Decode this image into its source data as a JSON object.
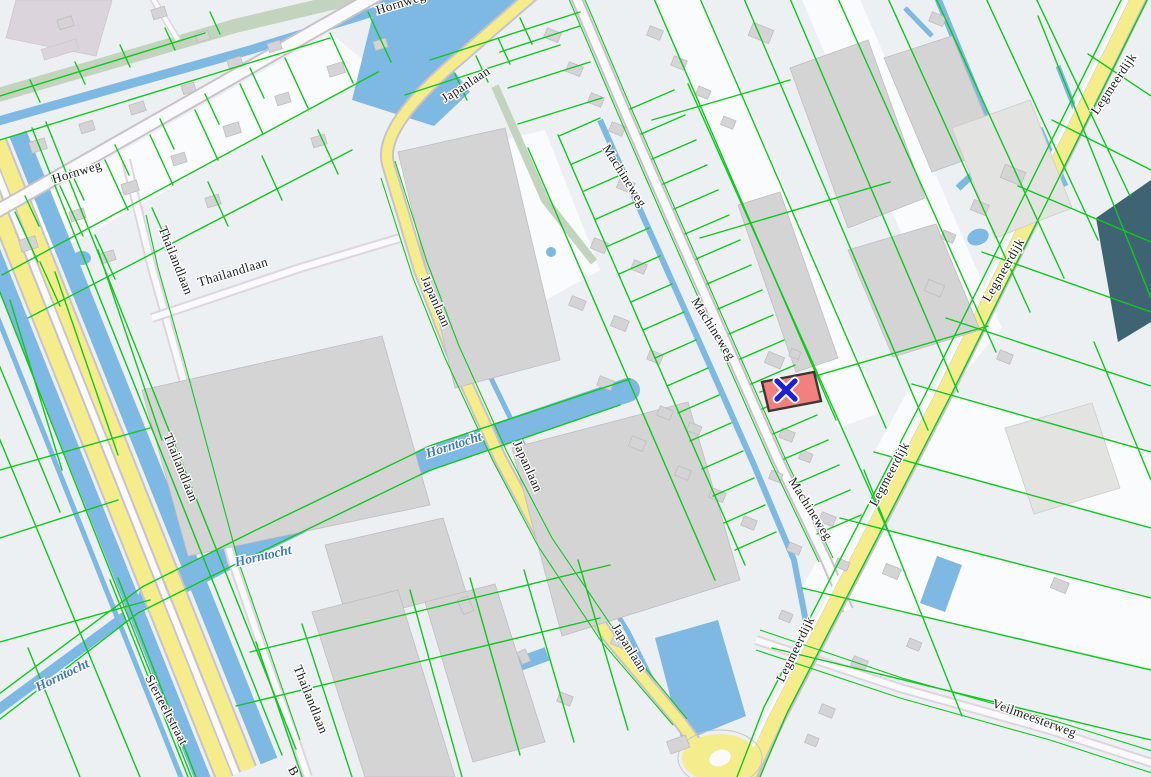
{
  "app": {
    "type": "cadastral-map-viewer",
    "description": "Dutch cadastral parcel map with highlighted parcel and selection marker"
  },
  "map": {
    "colors": {
      "bg": "#EDF0F3",
      "parcelLine": "#0FC81E",
      "water": "#7DB9E3",
      "roadYellow": "#F5EC8C",
      "roadWhite": "#FAF9FB",
      "roadCasing": "#C9C2C9",
      "minorCasing": "#DFD5DF",
      "building": "#D4D4D4",
      "buildingStroke": "#C2BCC2",
      "sage": "#C2D4BD",
      "darkParcel": "#3E6473",
      "lavender": "#DCD4DC",
      "parcelWhite": "#FAFBFC",
      "highlightFill": "#F2807E",
      "highlightStroke": "#3A3A30",
      "markerBlue": "#1B22D3",
      "labelText": "#1A1A1A",
      "waterText": "#3B79C4"
    },
    "labels": [
      {
        "text": "Hornweg",
        "x": 78,
        "y": 176,
        "rot": -17,
        "kind": "road"
      },
      {
        "text": "Hornweg",
        "x": 402,
        "y": 7,
        "rot": -17,
        "kind": "road"
      },
      {
        "text": "Japanlaan",
        "x": 468,
        "y": 88,
        "rot": -33,
        "kind": "road"
      },
      {
        "text": "Japanlaan",
        "x": 432,
        "y": 303,
        "rot": 66,
        "kind": "road"
      },
      {
        "text": "Japanlaan",
        "x": 524,
        "y": 468,
        "rot": 66,
        "kind": "road"
      },
      {
        "text": "Japanlaan",
        "x": 626,
        "y": 650,
        "rot": 58,
        "kind": "road"
      },
      {
        "text": "Thailandlaan",
        "x": 172,
        "y": 262,
        "rot": 68,
        "kind": "road"
      },
      {
        "text": "Thailandlaan",
        "x": 234,
        "y": 276,
        "rot": -17,
        "kind": "road"
      },
      {
        "text": "Thailandlaan",
        "x": 177,
        "y": 469,
        "rot": 68,
        "kind": "road"
      },
      {
        "text": "Thailandlaan",
        "x": 307,
        "y": 701,
        "rot": 68,
        "kind": "road"
      },
      {
        "text": "Machineweg",
        "x": 621,
        "y": 178,
        "rot": 58,
        "kind": "road"
      },
      {
        "text": "Machineweg",
        "x": 710,
        "y": 331,
        "rot": 58,
        "kind": "road"
      },
      {
        "text": "Machineweg",
        "x": 807,
        "y": 511,
        "rot": 58,
        "kind": "road"
      },
      {
        "text": "Legmeerdijk",
        "x": 1117,
        "y": 86,
        "rot": -56,
        "kind": "road"
      },
      {
        "text": "Legmeerdijk",
        "x": 1007,
        "y": 272,
        "rot": -60,
        "kind": "road"
      },
      {
        "text": "Legmeerdijk",
        "x": 893,
        "y": 476,
        "rot": -62,
        "kind": "road"
      },
      {
        "text": "Legmeerdijk",
        "x": 799,
        "y": 651,
        "rot": -64,
        "kind": "road"
      },
      {
        "text": "Veilmeesterweg",
        "x": 1033,
        "y": 722,
        "rot": 20,
        "kind": "road"
      },
      {
        "text": "Sierteeltstraat",
        "x": 163,
        "y": 712,
        "rot": 62,
        "kind": "road"
      },
      {
        "text": "B",
        "x": 290,
        "y": 773,
        "rot": 62,
        "kind": "road"
      },
      {
        "text": "Horntocht",
        "x": 455,
        "y": 449,
        "rot": -18,
        "kind": "water"
      },
      {
        "text": "Horntocht",
        "x": 264,
        "y": 560,
        "rot": -13,
        "kind": "water"
      },
      {
        "text": "Horntocht",
        "x": 64,
        "y": 679,
        "rot": -26,
        "kind": "water"
      }
    ],
    "highlighted_parcel": {
      "fill": "#F2807E",
      "stroke": "#3A3A30",
      "marker_symbol": "x-cross",
      "marker_color": "#1B22D3",
      "marker_x": 786,
      "marker_y": 390
    }
  }
}
